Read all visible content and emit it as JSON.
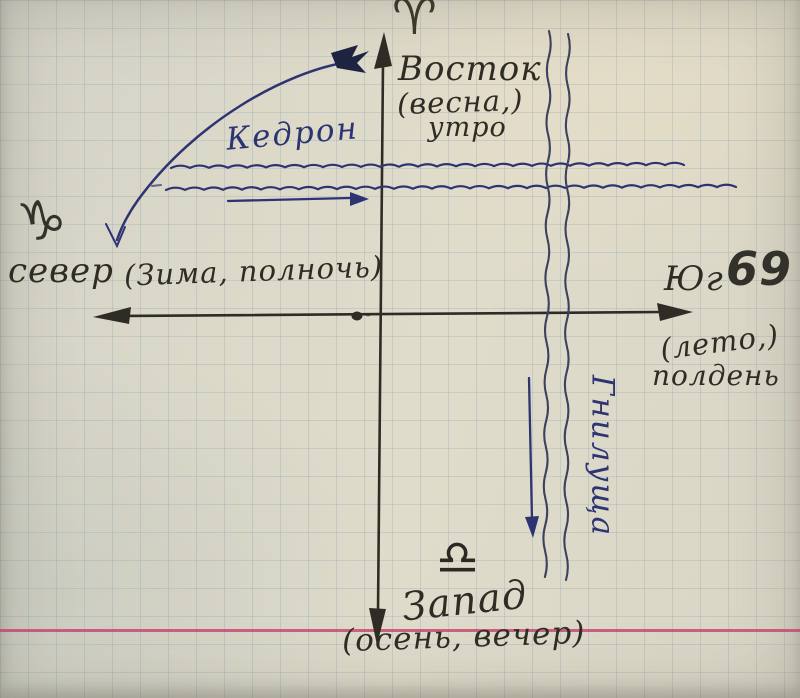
{
  "palette": {
    "paper": "#dcd9ca",
    "grid_blue": "#7a98b2",
    "ink_dark": "#2e2c24",
    "ink_blue": "#2e3472",
    "ink_blue_dark": "#1f2342",
    "ink_blue_dusk": "#3d4160",
    "margin_pink": "#c4416e"
  },
  "compass": {
    "east": {
      "zodiac_glyph": "♈",
      "zodiac_name": "aries",
      "label": "Восток",
      "season": "(весна,)",
      "time": "утро"
    },
    "north": {
      "zodiac_glyph": "♑",
      "zodiac_name": "capricorn",
      "label": "север",
      "detail": "(Зима, полночь)"
    },
    "south": {
      "label": "Юг",
      "zodiac_glyph": "69",
      "zodiac_name": "cancer",
      "season": "(лето,)",
      "time": "полдень"
    },
    "west": {
      "zodiac_glyph": "♎",
      "zodiac_name": "libra",
      "label": "Запад",
      "detail": "(осень, вечер)"
    }
  },
  "rivers": {
    "kedron": {
      "name": "Кедрон",
      "direction": "west-to-east"
    },
    "gnilushcha": {
      "name": "Гнилуща",
      "direction": "north-to-south"
    }
  }
}
